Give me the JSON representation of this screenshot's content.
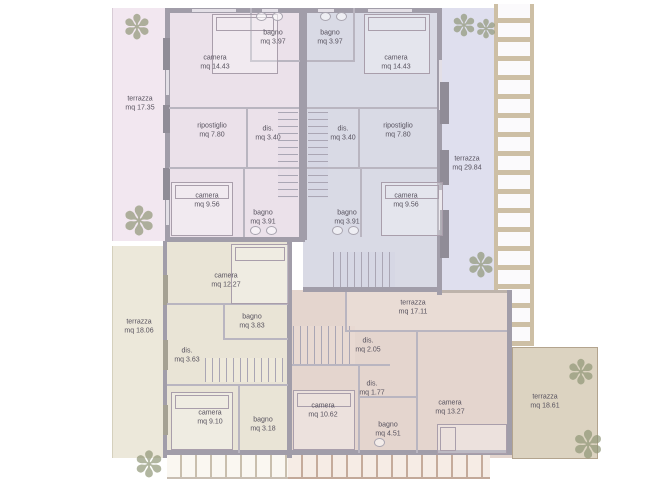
{
  "rooms": {
    "tl_terrazza": {
      "name": "terrazza",
      "area": "mq 17.35"
    },
    "tl_camera1": {
      "name": "camera",
      "area": "mq 14.43"
    },
    "tl_bagno1": {
      "name": "bagno",
      "area": "mq 3.97"
    },
    "tl_ripostiglio": {
      "name": "ripostiglio",
      "area": "mq 7.80"
    },
    "tl_dis": {
      "name": "dis.",
      "area": "mq 3.40"
    },
    "tl_camera2": {
      "name": "camera",
      "area": "mq 9.56"
    },
    "tl_bagno2": {
      "name": "bagno",
      "area": "mq 3.91"
    },
    "tr_bagno1": {
      "name": "bagno",
      "area": "mq 3.97"
    },
    "tr_camera1": {
      "name": "camera",
      "area": "mq 14.43"
    },
    "tr_dis": {
      "name": "dis.",
      "area": "mq 3.40"
    },
    "tr_ripostiglio": {
      "name": "ripostiglio",
      "area": "mq 7.80"
    },
    "tr_terrazza": {
      "name": "terrazza",
      "area": "mq 29.84"
    },
    "tr_bagno2": {
      "name": "bagno",
      "area": "mq 3.91"
    },
    "tr_camera2": {
      "name": "camera",
      "area": "mq 9.56"
    },
    "bl_terrazza": {
      "name": "terrazza",
      "area": "mq 18.06"
    },
    "bl_camera1": {
      "name": "camera",
      "area": "mq 12.27"
    },
    "bl_bagno1": {
      "name": "bagno",
      "area": "mq 3.83"
    },
    "bl_dis": {
      "name": "dis.",
      "area": "mq 3.63"
    },
    "bl_camera2": {
      "name": "camera",
      "area": "mq 9.10"
    },
    "bl_bagno2": {
      "name": "bagno",
      "area": "mq 3.18"
    },
    "br_terrazza1": {
      "name": "terrazza",
      "area": "mq 17.11"
    },
    "br_dis1": {
      "name": "dis.",
      "area": "mq 2.05"
    },
    "br_dis2": {
      "name": "dis.",
      "area": "mq 1.77"
    },
    "br_camera1": {
      "name": "camera",
      "area": "mq 10.62"
    },
    "br_bagno": {
      "name": "bagno",
      "area": "mq 4.51"
    },
    "br_camera2": {
      "name": "camera",
      "area": "mq 13.27"
    },
    "br_terrazza2": {
      "name": "terrazza",
      "area": "mq 18.61"
    }
  },
  "icons": {
    "tree": "✽"
  },
  "palette": {
    "unit_top_left": "#ebe1ea",
    "unit_top_right": "#d9dae5",
    "unit_bottom_left": "#e9e4d6",
    "unit_bottom_right": "#e4d5ce",
    "terrace_left_pink": "#f2e7f0",
    "terrace_right_blue": "#dfdfee",
    "terrace_left_cream": "#ece8da",
    "terrace_inner_rose": "#e9dcd5",
    "terrace_tan": "#dcd3c1",
    "wall": "#a19da9",
    "pergola": "#cdbfa5",
    "tree": "#8d9474",
    "text": "#57525e"
  }
}
